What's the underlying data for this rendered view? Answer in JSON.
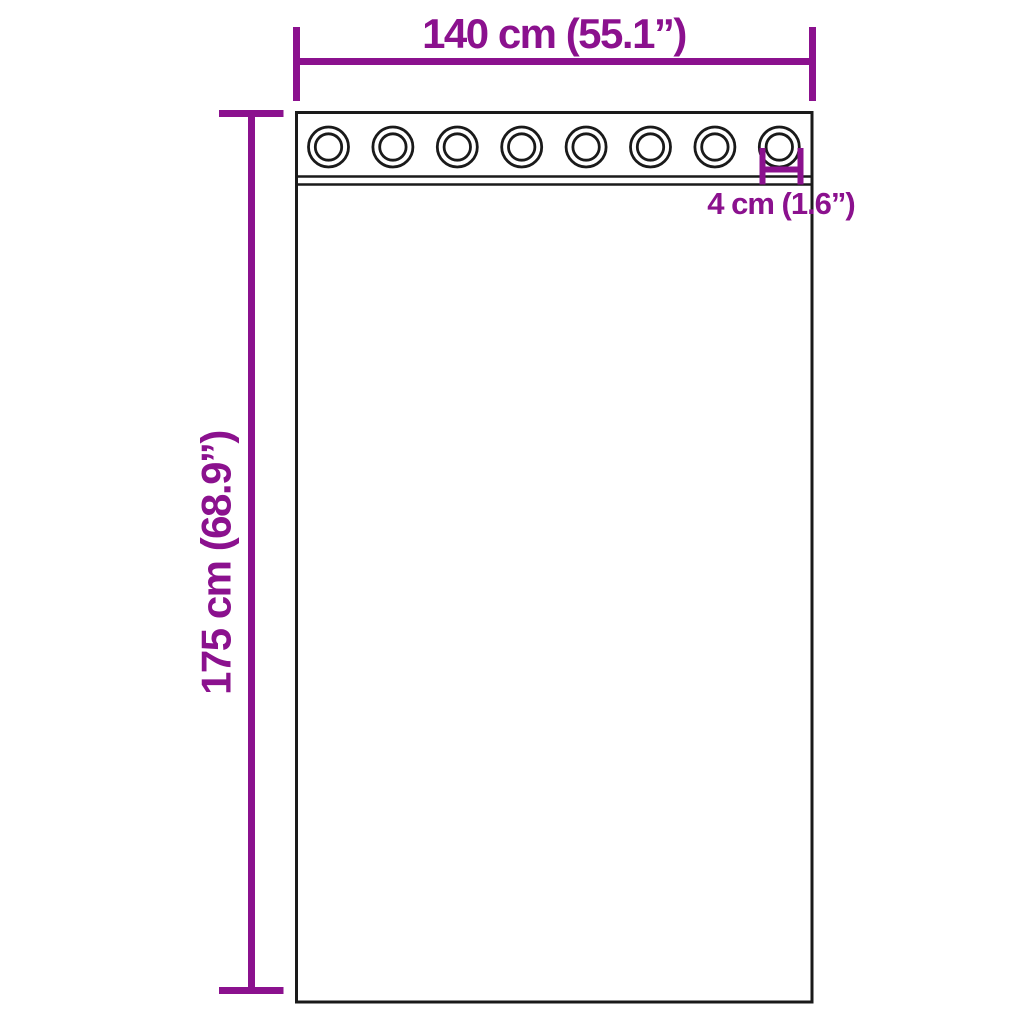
{
  "colors": {
    "accent": "#8B118E",
    "outline": "#1A1A1A",
    "panel_fill": "#FFFFFF",
    "background": "#FFFFFF"
  },
  "curtain": {
    "grommet_count": 8
  },
  "dimensions": {
    "width_label": "140 cm (55.1”)",
    "height_label": "175 cm (68.9”)",
    "grommet_label": "4 cm (1.6”)"
  }
}
